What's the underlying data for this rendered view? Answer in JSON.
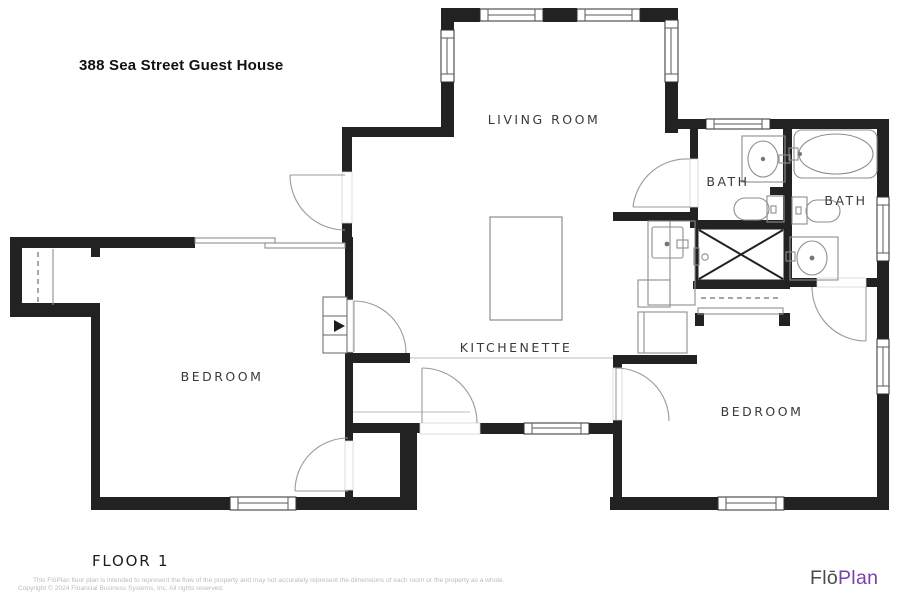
{
  "header": {
    "title": "388 Sea Street Guest House"
  },
  "plan": {
    "rooms": {
      "living_room": "LIVING ROOM",
      "kitchenette": "KITCHENETTE",
      "bedroom_left": "BEDROOM",
      "bedroom_right": "BEDROOM",
      "bath_left": "BATH",
      "bath_right": "BATH"
    }
  },
  "footer": {
    "floor_label": "FLOOR 1",
    "disclaimer": "This FlōPlan floor plan is intended to represent the flow of the property and may not accurately represent the dimensions of each room or the property as a whole.",
    "copyright": "Copyright © 2024 Financial Business Systems, Inc. All rights reserved.",
    "logo_prefix": "Flō",
    "logo_suffix": "Plan"
  },
  "colors": {
    "wall": "#222222",
    "fixture": "#8e8e8e",
    "door": "#9a9a9a",
    "label": "#3a3a3a",
    "logo_prefix": "#4a4a4e",
    "logo_suffix": "#7b3fae",
    "footer_text": "#bcbcbc"
  }
}
